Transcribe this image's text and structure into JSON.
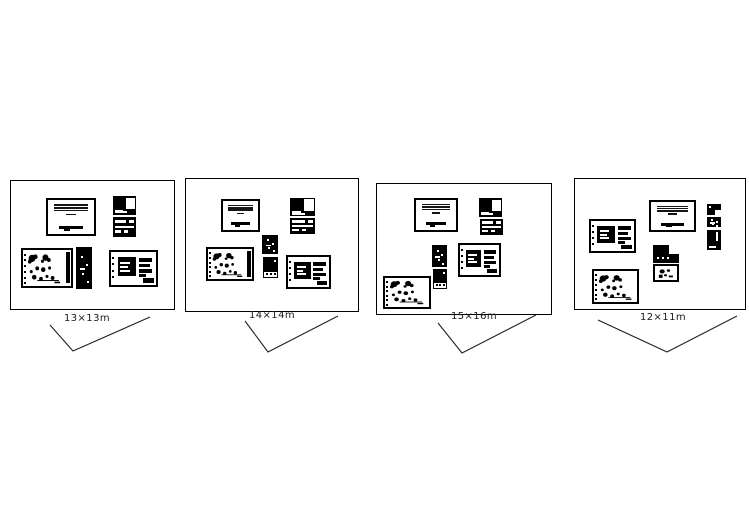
{
  "panels": [
    {
      "id": "option-1",
      "label": "13×13m",
      "frame": {
        "x": 10,
        "y": 180,
        "w": 165,
        "h": 130
      },
      "label_pos": {
        "cx": 87,
        "y": 314
      },
      "check": [
        [
          50,
          325
        ],
        [
          73,
          351
        ],
        [
          150,
          317
        ]
      ],
      "sheets": [
        {
          "type": "title",
          "x": 35,
          "y": 17,
          "w": 50,
          "h": 38
        },
        {
          "type": "darkA",
          "x": 102,
          "y": 15,
          "w": 23,
          "h": 19
        },
        {
          "type": "darkB",
          "x": 102,
          "y": 36,
          "w": 23,
          "h": 20
        },
        {
          "type": "plan",
          "x": 10,
          "y": 67,
          "w": 52,
          "h": 40,
          "rightStrip": true
        },
        {
          "type": "darkPlain",
          "x": 65,
          "y": 66,
          "w": 16,
          "h": 42
        },
        {
          "type": "detail",
          "x": 98,
          "y": 69,
          "w": 49,
          "h": 37
        }
      ]
    },
    {
      "id": "option-2",
      "label": "14×14m",
      "frame": {
        "x": 185,
        "y": 178,
        "w": 174,
        "h": 134
      },
      "label_pos": {
        "cx": 272,
        "y": 311
      },
      "check": [
        [
          245,
          321
        ],
        [
          268,
          352
        ],
        [
          338,
          316
        ]
      ],
      "sheets": [
        {
          "type": "title",
          "x": 35,
          "y": 20,
          "w": 39,
          "h": 33
        },
        {
          "type": "darkA",
          "x": 104,
          "y": 19,
          "w": 25,
          "h": 18
        },
        {
          "type": "darkB",
          "x": 104,
          "y": 39,
          "w": 25,
          "h": 16
        },
        {
          "type": "darkPlain",
          "x": 76,
          "y": 56,
          "w": 16,
          "h": 19
        },
        {
          "type": "darkDotted",
          "x": 77,
          "y": 78,
          "w": 15,
          "h": 21
        },
        {
          "type": "plan",
          "x": 20,
          "y": 68,
          "w": 48,
          "h": 34,
          "rightStrip": true
        },
        {
          "type": "detail",
          "x": 100,
          "y": 76,
          "w": 45,
          "h": 34
        }
      ]
    },
    {
      "id": "option-3",
      "label": "15×16m",
      "frame": {
        "x": 376,
        "y": 183,
        "w": 176,
        "h": 132
      },
      "label_pos": {
        "cx": 474,
        "y": 312
      },
      "check": [
        [
          438,
          323
        ],
        [
          462,
          353
        ],
        [
          536,
          315
        ]
      ],
      "sheets": [
        {
          "type": "title",
          "x": 37,
          "y": 14,
          "w": 44,
          "h": 34
        },
        {
          "type": "darkA",
          "x": 102,
          "y": 14,
          "w": 23,
          "h": 19
        },
        {
          "type": "darkB",
          "x": 103,
          "y": 35,
          "w": 23,
          "h": 16
        },
        {
          "type": "darkPlain",
          "x": 55,
          "y": 61,
          "w": 15,
          "h": 22
        },
        {
          "type": "darkDotted",
          "x": 56,
          "y": 85,
          "w": 14,
          "h": 20
        },
        {
          "type": "detail",
          "x": 81,
          "y": 59,
          "w": 43,
          "h": 34
        },
        {
          "type": "plan",
          "x": 6,
          "y": 92,
          "w": 48,
          "h": 33,
          "rightStrip": false
        }
      ]
    },
    {
      "id": "option-4",
      "label": "12×11m",
      "frame": {
        "x": 574,
        "y": 178,
        "w": 172,
        "h": 132
      },
      "label_pos": {
        "cx": 663,
        "y": 313
      },
      "check": [
        [
          598,
          320
        ],
        [
          667,
          352
        ],
        [
          737,
          316
        ]
      ],
      "sheets": [
        {
          "type": "title",
          "x": 74,
          "y": 21,
          "w": 47,
          "h": 32
        },
        {
          "type": "darkNotch",
          "x": 132,
          "y": 25,
          "w": 14,
          "h": 11
        },
        {
          "type": "darkPlain",
          "x": 132,
          "y": 38,
          "w": 14,
          "h": 10
        },
        {
          "type": "darkSlit",
          "x": 132,
          "y": 51,
          "w": 14,
          "h": 20
        },
        {
          "type": "detail",
          "x": 14,
          "y": 40,
          "w": 47,
          "h": 34
        },
        {
          "type": "darkHalf",
          "x": 78,
          "y": 66,
          "w": 26,
          "h": 18
        },
        {
          "type": "framed",
          "x": 78,
          "y": 85,
          "w": 26,
          "h": 18
        },
        {
          "type": "plan",
          "x": 17,
          "y": 90,
          "w": 47,
          "h": 35,
          "rightStrip": false
        }
      ]
    }
  ],
  "line_color": "#222222",
  "ink_color": "#000000"
}
